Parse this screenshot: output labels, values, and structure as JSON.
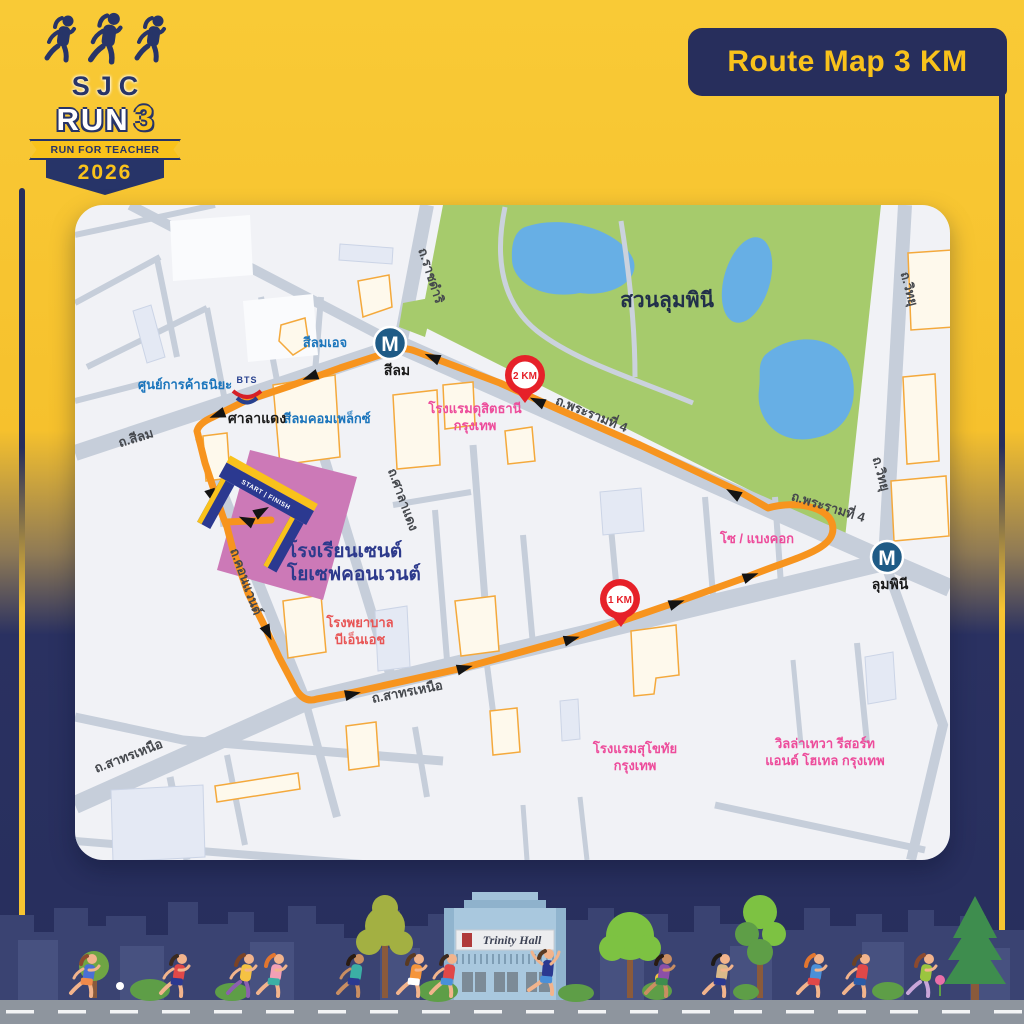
{
  "logo": {
    "acronym": "SJC",
    "run_word": "RUN",
    "run_number": "3",
    "tagline": "RUN FOR TEACHER",
    "year": "2026"
  },
  "badge": {
    "title": "Route Map 3 KM"
  },
  "map": {
    "park_label": "สวนลุมพินี",
    "streets": {
      "silom": "ถ.สีลม",
      "ratchadamri": "ถ.ราชดำริ",
      "witthayu": "ถ.วิทยุ",
      "rama4": "ถ.พระรามที่ 4",
      "sathorn_north": "ถ.สาทรเหนือ",
      "convent": "ถ.คอนแวนต์",
      "saladaeng_road": "ถ.ศาลาแดง"
    },
    "stations": {
      "metro_symbol": "M",
      "mrt_silom_label": "สีลม",
      "mrt_lumpini_label": "ลุมพินี",
      "bts_logo": "BTS",
      "bts_saladaeng_label": "ศาลาแดง"
    },
    "landmarks": {
      "thaniya": "ศูนย์การค้าธนิยะ",
      "silom_edge": "สีลมเอจ",
      "silom_complex": "สีลมคอมเพล็กซ์",
      "dusit_line1": "โรงแรมดุสิตธานี",
      "dusit_line2": "กรุงเทพ",
      "so_bangkok": "โซ / แบงคอก",
      "bnh_line1": "โรงพยาบาล",
      "bnh_line2": "บีเอ็นเอช",
      "sukhothai_line1": "โรงแรมสุโขทัย",
      "sukhothai_line2": "กรุงเทพ",
      "villa_line1": "วิลล่าเทวา รีสอร์ท",
      "villa_line2": "แอนด์ โฮเทล กรุงเทพ"
    },
    "school": {
      "line1": "โรงเรียนเซนต์",
      "line2": "โยเซฟคอนเวนต์"
    },
    "markers": {
      "km1": "1 KM",
      "km2": "2 KM",
      "start_finish": "START | FINISH"
    }
  },
  "footer": {
    "building_sign": "Trinity Hall"
  },
  "colors": {
    "navy": "#272E5C",
    "yellow": "#F7C431",
    "route_orange": "#F7941E",
    "pin_red": "#E62129",
    "park_green": "#A6CB6C",
    "pond_blue": "#67AFE5",
    "school_pink": "#CC79B7",
    "road_gray": "#C6CEDA"
  }
}
